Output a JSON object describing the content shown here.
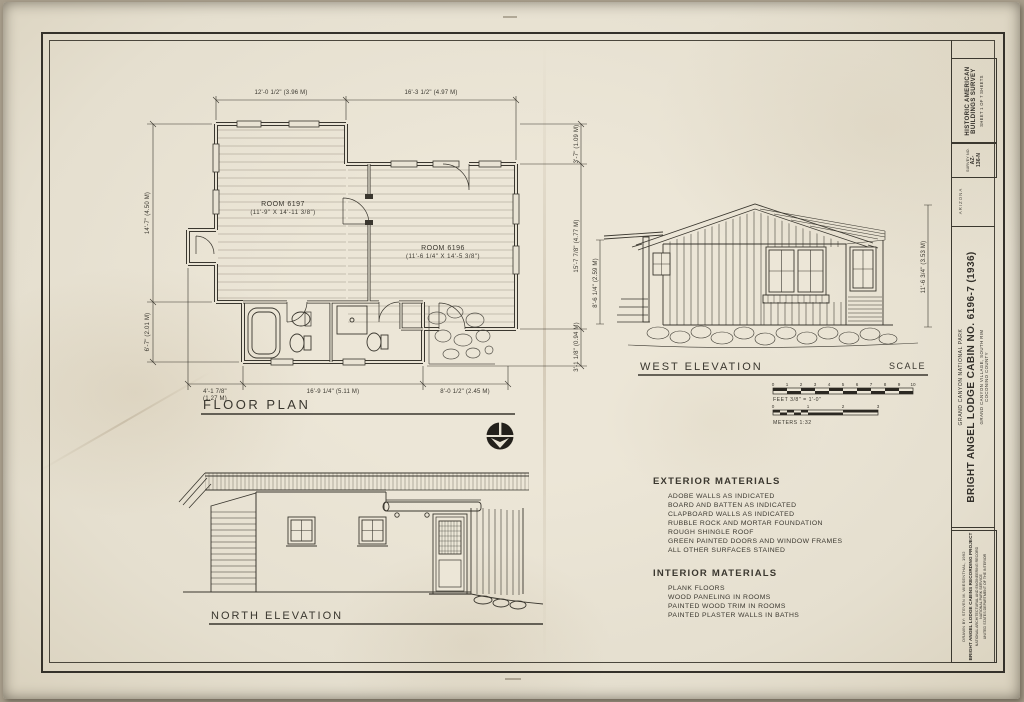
{
  "colors": {
    "ink": "#3a372f",
    "paper": "#e9e3d4"
  },
  "floor_plan": {
    "title": "FLOOR PLAN",
    "room1_name": "ROOM 6197",
    "room1_size": "(11'-9\" X 14'-11 3/8\")",
    "room2_name": "ROOM 6196",
    "room2_size": "(11'-6 1/4\" X 14'-5 3/8\")",
    "dim_top_1": "12'-0 1/2\" (3.96 M)",
    "dim_top_2": "16'-3 1/2\" (4.97 M)",
    "dim_left_1": "14'-7\" (4.50 M)",
    "dim_left_2": "6'-7\" (2.01 M)",
    "dim_right_1": "3'-7\" (1.09 M)",
    "dim_right_2": "15'-7 7/8\" (4.77 M)",
    "dim_right_3": "3'-1 1/8\" (0.94 M)",
    "dim_bot_1a": "4'-1 7/8\"",
    "dim_bot_1b": "(1.27 M)",
    "dim_bot_2": "16'-9 1/4\" (5.11 M)",
    "dim_bot_3": "8'-0 1/2\" (2.45 M)"
  },
  "west_elevation": {
    "title": "WEST ELEVATION",
    "scale_label": "SCALE",
    "dim_left": "8'-6 1/4\" (2.59 M)",
    "dim_right": "11'-6 3/4\" (3.53 M)"
  },
  "north_elevation": {
    "title": "NORTH ELEVATION"
  },
  "scale_bar": {
    "feet": [
      "0",
      "1",
      "2",
      "3",
      "4",
      "5",
      "6",
      "7",
      "8",
      "9",
      "10"
    ],
    "feet_label": "FEET 3/8\" = 1'-0\"",
    "meters": [
      "0",
      "1",
      "2",
      "3"
    ],
    "meters_label": "METERS 1:32"
  },
  "materials": {
    "exterior": {
      "heading": "EXTERIOR MATERIALS",
      "items": [
        "ADOBE WALLS AS INDICATED",
        "BOARD AND BATTEN AS INDICATED",
        "CLAPBOARD WALLS AS INDICATED",
        "RUBBLE ROCK AND MORTAR FOUNDATION",
        "ROUGH SHINGLE ROOF",
        "GREEN PAINTED DOORS AND WINDOW FRAMES",
        "ALL OTHER SURFACES STAINED"
      ]
    },
    "interior": {
      "heading": "INTERIOR MATERIALS",
      "items": [
        "PLANK FLOORS",
        "WOOD PANELING IN ROOMS",
        "PAINTED WOOD TRIM IN ROOMS",
        "PAINTED PLASTER WALLS IN BATHS"
      ]
    }
  },
  "title_block": {
    "habs_line1": "HISTORIC AMERICAN",
    "habs_line2": "BUILDINGS SURVEY",
    "habs_sheet": "SHEET 1 OF 7 SHEETS",
    "survey_label": "SURVEY NO.",
    "survey_no1": "AZ-",
    "survey_no2": "136-N",
    "state": "ARIZONA",
    "park": "GRAND CANYON NATIONAL PARK",
    "title": "BRIGHT ANGEL  LODGE  CABIN  NO. 6196-7  (1936)",
    "location1": "GRAND CANYON VILLAGE, SOUTH RIM",
    "location2": "COCONINO COUNTY",
    "drawn_by": "DRAWN BY: STEVEN M. WIESENTHAL, 1992",
    "project": "BRIGHT ANGEL LODGE CABINS RECORDING PROJECT",
    "org1": "NATIONAL ARCHITECTURAL AND ENGINEERING RECORD",
    "org2": "NATIONAL PARK SERVICE",
    "org3": "UNITED STATES DEPARTMENT OF THE INTERIOR"
  }
}
